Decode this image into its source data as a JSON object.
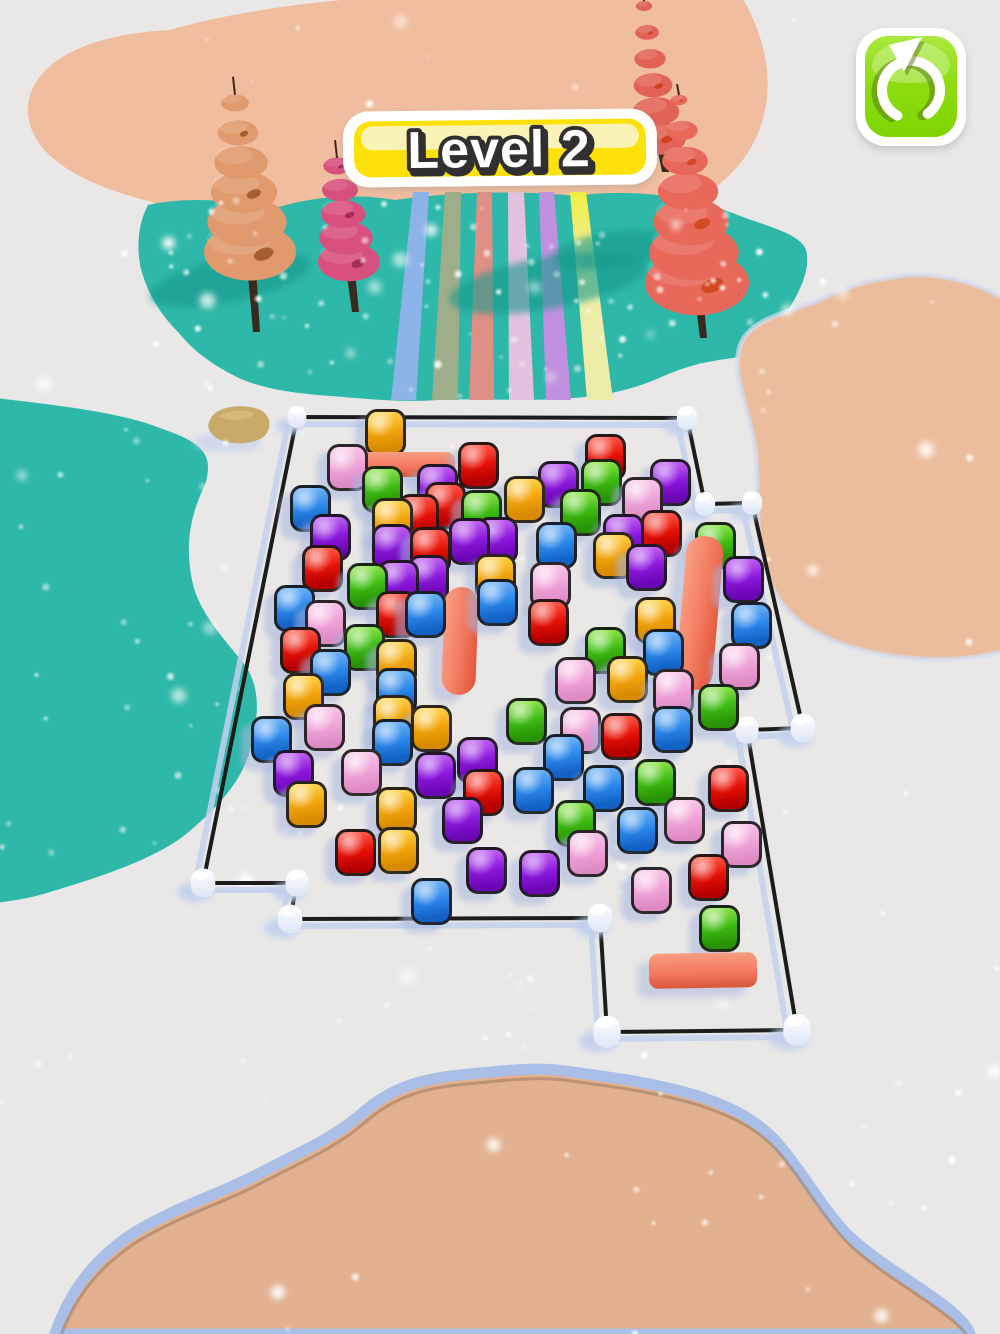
{
  "hud": {
    "level_banner": {
      "label": "Level 2",
      "bg": "#ffe10a",
      "shine": "#faf3b6",
      "border": "#ffffff",
      "text_color": "#ffffff",
      "text_outline": "#303030"
    },
    "restart_button": {
      "icon": "restart-circular-arrow-icon",
      "bg": "#8fdd12",
      "border": "#ffffff",
      "glyph_color": "#ffffff"
    }
  },
  "scene": {
    "background": "#e9e8e6",
    "terrain": {
      "teal": "#2eb8a9",
      "teal_shadow": "#169a8c",
      "peach_top": "#f0bd9e",
      "peach_right": "#ecbd9c",
      "peach_bottom": "#e2b190",
      "snow_edge_blue": "#a9bfe8",
      "inner_shadow_brown": "#8f6f55",
      "rock": "#c9ab69",
      "snow_dot": "#ffffff"
    },
    "trees": [
      {
        "name": "tan-tree",
        "x": 250,
        "base_y": 252,
        "top_y": 103,
        "base_r": 46,
        "layers": 6,
        "trunk_to": 332,
        "color": "#e09a6d",
        "spot": "#a15c2c"
      },
      {
        "name": "pink-tree",
        "x": 349,
        "base_y": 262,
        "top_y": 166,
        "base_r": 31,
        "layers": 5,
        "trunk_to": 312,
        "color": "#d94f7d",
        "spot": "#a32a52"
      },
      {
        "name": "coral-tree-small",
        "x": 659,
        "base_y": 138,
        "top_y": 6,
        "base_r": 27,
        "layers": 6,
        "trunk_to": 172,
        "color": "#e26355",
        "spot": "#cf3f1f"
      },
      {
        "name": "coral-tree-large",
        "x": 697,
        "base_y": 283,
        "top_y": 100,
        "base_r": 52,
        "layers": 7,
        "trunk_to": 338,
        "color": "#e8685a",
        "spot": "#d2491f"
      }
    ],
    "tree_shadows": [
      {
        "x": 230,
        "y": 280,
        "rx": 82,
        "ry": 22,
        "rot": -12
      },
      {
        "x": 548,
        "y": 283,
        "rx": 100,
        "ry": 26,
        "rot": -10
      },
      {
        "x": 612,
        "y": 250,
        "rx": 60,
        "ry": 18,
        "rot": -8
      }
    ],
    "lanes": {
      "top_y": 192,
      "bottom_y": 400,
      "items": [
        {
          "name": "lane-blue",
          "color": "#8db4e8",
          "top": [
            413,
            429
          ],
          "bottom": [
            391,
            416
          ]
        },
        {
          "name": "lane-sage",
          "color": "#9fae8a",
          "top": [
            445,
            461
          ],
          "bottom": [
            432,
            458
          ]
        },
        {
          "name": "lane-salmon",
          "color": "#df8f85",
          "top": [
            477,
            492
          ],
          "bottom": [
            469,
            494
          ]
        },
        {
          "name": "lane-pink",
          "color": "#e2c2de",
          "top": [
            508,
            524
          ],
          "bottom": [
            509,
            534
          ]
        },
        {
          "name": "lane-lilac",
          "color": "#c290e0",
          "top": [
            539,
            554
          ],
          "bottom": [
            546,
            571
          ]
        },
        {
          "name": "lane-yellow",
          "color": "#f3ef3e",
          "color2": "#ededa9",
          "top": [
            570,
            586
          ],
          "bottom": [
            587,
            613
          ]
        }
      ]
    },
    "fence": {
      "line_color": "#1c1c1c",
      "shadow_color": "#c3d0ee",
      "post_color": "#ffffff",
      "points": [
        [
          297,
          417
        ],
        [
          687,
          418
        ],
        [
          705,
          504
        ],
        [
          752,
          503
        ],
        [
          803,
          728
        ],
        [
          747,
          730
        ],
        [
          797,
          1030
        ],
        [
          607,
          1032
        ],
        [
          600,
          918
        ],
        [
          290,
          919
        ],
        [
          297,
          883
        ],
        [
          203,
          883
        ]
      ],
      "posts": [
        [
          297,
          417,
          13
        ],
        [
          687,
          418,
          14
        ],
        [
          705,
          504,
          14
        ],
        [
          752,
          503,
          14
        ],
        [
          803,
          728,
          17
        ],
        [
          747,
          730,
          16
        ],
        [
          797,
          1030,
          19
        ],
        [
          607,
          1032,
          19
        ],
        [
          600,
          918,
          17
        ],
        [
          290,
          919,
          17
        ],
        [
          297,
          883,
          16
        ],
        [
          203,
          883,
          17
        ]
      ]
    },
    "bars": {
      "color": "#f4755a",
      "items": [
        {
          "x": 408,
          "y": 464,
          "w": 94,
          "h": 25,
          "rot": 0,
          "dir": "h"
        },
        {
          "x": 460,
          "y": 641,
          "w": 34,
          "h": 108,
          "rot": 2,
          "dir": "v"
        },
        {
          "x": 699,
          "y": 613,
          "w": 37,
          "h": 154,
          "rot": 5,
          "dir": "v"
        },
        {
          "x": 703,
          "y": 970,
          "w": 108,
          "h": 35,
          "rot": -1,
          "dir": "h"
        }
      ]
    },
    "cube_size": {
      "w": 41,
      "h": 47
    },
    "cubes": [
      [
        385,
        432,
        "orange"
      ],
      [
        347,
        467,
        "pink"
      ],
      [
        478,
        465,
        "red"
      ],
      [
        605,
        457,
        "red"
      ],
      [
        382,
        489,
        "green"
      ],
      [
        437,
        487,
        "purple"
      ],
      [
        558,
        484,
        "purple"
      ],
      [
        601,
        482,
        "green"
      ],
      [
        670,
        482,
        "purple"
      ],
      [
        310,
        508,
        "blue"
      ],
      [
        445,
        505,
        "red"
      ],
      [
        524,
        499,
        "orange"
      ],
      [
        642,
        500,
        "pink"
      ],
      [
        481,
        513,
        "green"
      ],
      [
        580,
        512,
        "green"
      ],
      [
        392,
        521,
        "orange"
      ],
      [
        418,
        517,
        "red"
      ],
      [
        330,
        537,
        "purple"
      ],
      [
        392,
        547,
        "purple"
      ],
      [
        430,
        550,
        "red"
      ],
      [
        469,
        541,
        "purple"
      ],
      [
        497,
        540,
        "purple"
      ],
      [
        556,
        545,
        "blue"
      ],
      [
        623,
        537,
        "purple"
      ],
      [
        661,
        533,
        "red"
      ],
      [
        715,
        545,
        "green"
      ],
      [
        613,
        555,
        "orange"
      ],
      [
        646,
        567,
        "purple"
      ],
      [
        743,
        579,
        "purple"
      ],
      [
        322,
        568,
        "red"
      ],
      [
        367,
        586,
        "green"
      ],
      [
        398,
        583,
        "purple"
      ],
      [
        428,
        578,
        "purple"
      ],
      [
        495,
        577,
        "orange"
      ],
      [
        550,
        585,
        "pink"
      ],
      [
        294,
        608,
        "blue"
      ],
      [
        325,
        623,
        "pink"
      ],
      [
        396,
        614,
        "red"
      ],
      [
        425,
        614,
        "blue"
      ],
      [
        497,
        602,
        "blue"
      ],
      [
        548,
        622,
        "red"
      ],
      [
        655,
        620,
        "orange"
      ],
      [
        751,
        625,
        "blue"
      ],
      [
        300,
        650,
        "red"
      ],
      [
        364,
        647,
        "green"
      ],
      [
        396,
        662,
        "orange"
      ],
      [
        605,
        650,
        "green"
      ],
      [
        663,
        652,
        "blue"
      ],
      [
        739,
        666,
        "pink"
      ],
      [
        330,
        672,
        "blue"
      ],
      [
        303,
        696,
        "orange"
      ],
      [
        396,
        691,
        "blue"
      ],
      [
        575,
        680,
        "pink"
      ],
      [
        627,
        679,
        "orange"
      ],
      [
        673,
        692,
        "pink"
      ],
      [
        718,
        707,
        "green"
      ],
      [
        324,
        727,
        "pink"
      ],
      [
        393,
        718,
        "orange"
      ],
      [
        431,
        728,
        "orange"
      ],
      [
        271,
        739,
        "blue"
      ],
      [
        392,
        742,
        "blue"
      ],
      [
        526,
        721,
        "green"
      ],
      [
        580,
        730,
        "pink"
      ],
      [
        621,
        736,
        "red"
      ],
      [
        672,
        729,
        "blue"
      ],
      [
        293,
        773,
        "purple"
      ],
      [
        361,
        772,
        "pink"
      ],
      [
        435,
        775,
        "purple"
      ],
      [
        477,
        760,
        "purple"
      ],
      [
        483,
        792,
        "red"
      ],
      [
        563,
        757,
        "blue"
      ],
      [
        655,
        782,
        "green"
      ],
      [
        533,
        790,
        "blue"
      ],
      [
        603,
        788,
        "blue"
      ],
      [
        728,
        788,
        "red"
      ],
      [
        306,
        804,
        "orange"
      ],
      [
        396,
        810,
        "orange"
      ],
      [
        462,
        820,
        "purple"
      ],
      [
        575,
        823,
        "green"
      ],
      [
        684,
        820,
        "pink"
      ],
      [
        637,
        830,
        "blue"
      ],
      [
        355,
        852,
        "red"
      ],
      [
        398,
        850,
        "orange"
      ],
      [
        486,
        870,
        "purple"
      ],
      [
        539,
        873,
        "purple"
      ],
      [
        587,
        853,
        "pink"
      ],
      [
        741,
        844,
        "pink"
      ],
      [
        708,
        877,
        "red"
      ],
      [
        651,
        890,
        "pink"
      ],
      [
        431,
        901,
        "blue"
      ],
      [
        719,
        928,
        "green"
      ]
    ]
  }
}
